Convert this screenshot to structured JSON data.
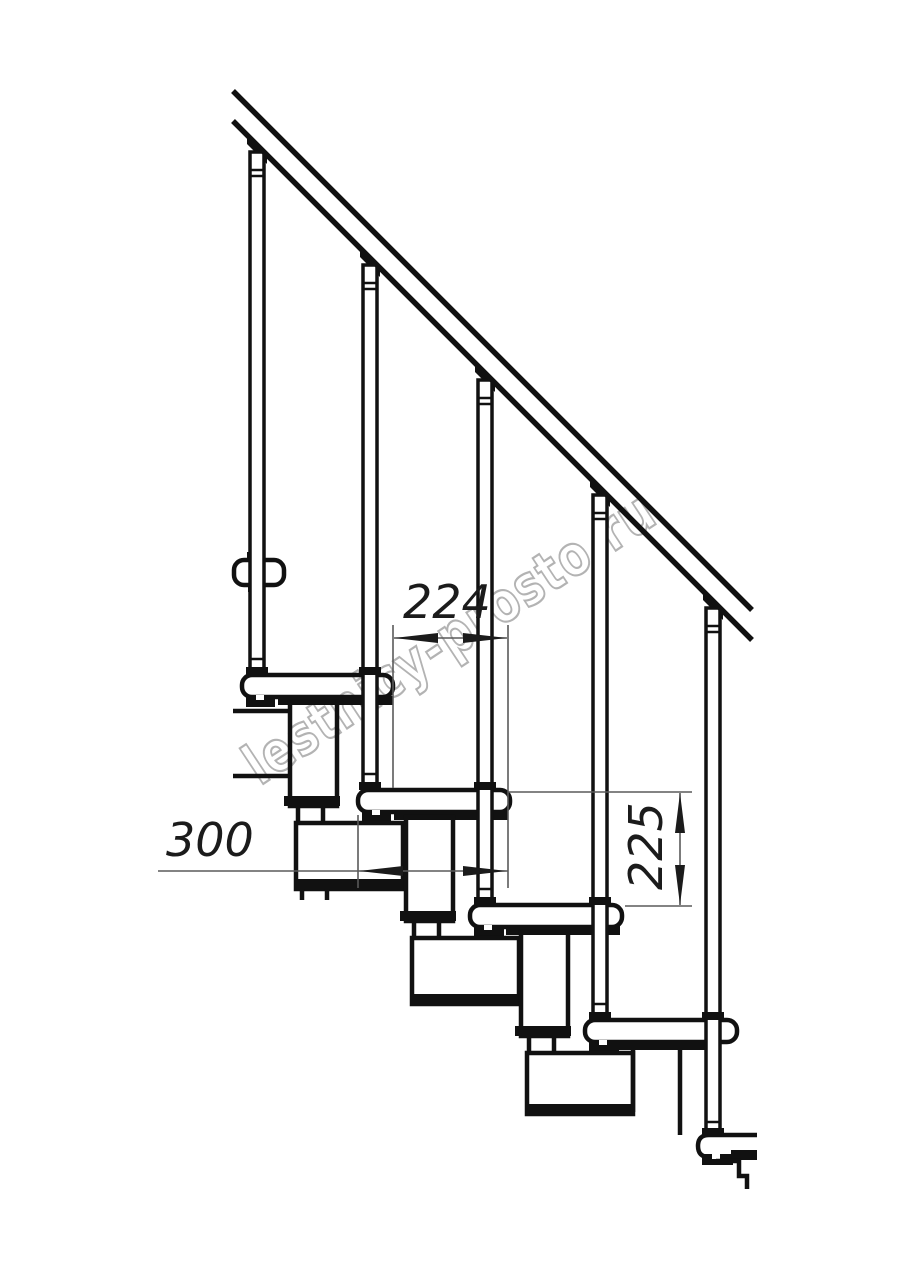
{
  "drawing": {
    "title": "modular-staircase-side-view",
    "watermark": {
      "text": "lestnicy-prosto.ru",
      "color": "#b3b3b3"
    },
    "line_color": "#111111",
    "dim_line_color": "#5a5a5a",
    "dimensions": {
      "going": {
        "label": "224"
      },
      "depth": {
        "label": "300"
      },
      "rise": {
        "label": "225"
      }
    }
  }
}
